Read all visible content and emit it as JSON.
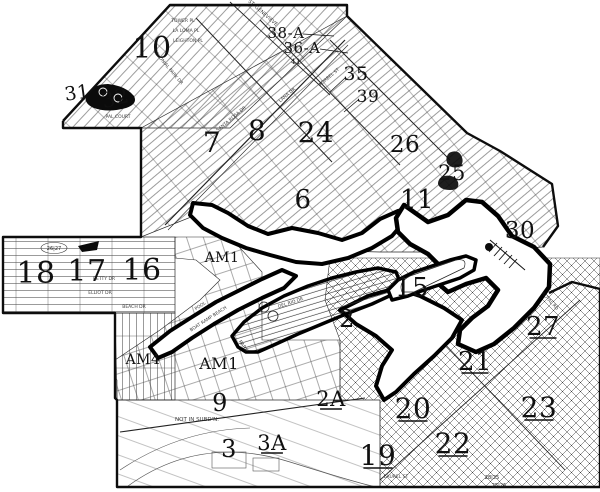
{
  "map": {
    "title": "subdivision-tract-map-scan",
    "colors": {
      "ink": "#101010",
      "paper": "#ffffff",
      "water_outline": "#000000",
      "faint_street": "#3c3c3c"
    },
    "zone_labels": [
      {
        "id": "10",
        "t": "10",
        "x": 152,
        "y": 58,
        "fs": 30
      },
      {
        "id": "31",
        "t": "31",
        "x": 78,
        "y": 99,
        "fs": 19,
        "rot": -8
      },
      {
        "id": "32",
        "t": "32",
        "x": 117,
        "y": 105,
        "fs": 21,
        "rot": -14
      },
      {
        "id": "7",
        "t": "7",
        "x": 212,
        "y": 152,
        "fs": 28
      },
      {
        "id": "8",
        "t": "8",
        "x": 257,
        "y": 140,
        "fs": 28
      },
      {
        "id": "24",
        "t": "24",
        "x": 316,
        "y": 142,
        "fs": 28
      },
      {
        "id": "6",
        "t": "6",
        "x": 303,
        "y": 208,
        "fs": 26
      },
      {
        "id": "26",
        "t": "26",
        "x": 405,
        "y": 152,
        "fs": 23
      },
      {
        "id": "25",
        "t": "25",
        "x": 452,
        "y": 180,
        "fs": 21
      },
      {
        "id": "11",
        "t": "11",
        "x": 417,
        "y": 208,
        "fs": 26
      },
      {
        "id": "30",
        "t": "30",
        "x": 520,
        "y": 238,
        "fs": 23
      },
      {
        "id": "35",
        "t": "35",
        "x": 356,
        "y": 80,
        "fs": 19
      },
      {
        "id": "39",
        "t": "39",
        "x": 368,
        "y": 102,
        "fs": 17
      },
      {
        "id": "38A",
        "t": "38-A",
        "x": 286,
        "y": 38,
        "fs": 15
      },
      {
        "id": "36A",
        "t": "36-A",
        "x": 302,
        "y": 53,
        "fs": 15
      },
      {
        "id": "41",
        "t": "41",
        "x": 296,
        "y": 64,
        "fs": 7
      },
      {
        "id": "18",
        "t": "18",
        "x": 36,
        "y": 283,
        "fs": 30
      },
      {
        "id": "17",
        "t": "17",
        "x": 87,
        "y": 281,
        "fs": 30
      },
      {
        "id": "16",
        "t": "16",
        "x": 142,
        "y": 280,
        "fs": 30
      },
      {
        "id": "15",
        "t": "15",
        "x": 412,
        "y": 296,
        "fs": 26
      },
      {
        "id": "2",
        "t": "2",
        "x": 347,
        "y": 327,
        "fs": 24
      },
      {
        "id": "2A",
        "t": "2A",
        "x": 331,
        "y": 406,
        "fs": 21,
        "u": 1
      },
      {
        "id": "21",
        "t": "21",
        "x": 475,
        "y": 370,
        "fs": 26,
        "u": 1
      },
      {
        "id": "27",
        "t": "27",
        "x": 543,
        "y": 335,
        "fs": 26,
        "u": 1
      },
      {
        "id": "20",
        "t": "20",
        "x": 413,
        "y": 418,
        "fs": 28,
        "u": 1
      },
      {
        "id": "23",
        "t": "23",
        "x": 539,
        "y": 417,
        "fs": 28,
        "u": 1
      },
      {
        "id": "22",
        "t": "22",
        "x": 453,
        "y": 453,
        "fs": 28,
        "u": 1
      },
      {
        "id": "19",
        "t": "19",
        "x": 378,
        "y": 465,
        "fs": 28,
        "u": 1
      },
      {
        "id": "9",
        "t": "9",
        "x": 220,
        "y": 411,
        "fs": 24
      },
      {
        "id": "3",
        "t": "3",
        "x": 229,
        "y": 457,
        "fs": 24
      },
      {
        "id": "3A",
        "t": "3A",
        "x": 272,
        "y": 450,
        "fs": 21,
        "u": 1
      },
      {
        "id": "AM1-lagoon",
        "t": "AM1",
        "x": 222,
        "y": 262,
        "fs": 14
      },
      {
        "id": "AM4",
        "t": "AM4",
        "x": 143,
        "y": 364,
        "fs": 14
      },
      {
        "id": "AM1-park",
        "t": "AM1",
        "x": 219,
        "y": 369,
        "fs": 16
      }
    ],
    "street_labels": [
      {
        "t": "ST. GENEVIEVE",
        "x": 262,
        "y": 14,
        "rot": 41,
        "fs": 5
      },
      {
        "t": "TOWER PL",
        "x": 183,
        "y": 22,
        "fs": 4.5
      },
      {
        "t": "LA LOMA PL",
        "x": 186,
        "y": 32,
        "fs": 4.5
      },
      {
        "t": "LEIGHTON PL",
        "x": 188,
        "y": 42,
        "fs": 4.5
      },
      {
        "t": "COLONIAL PARK DR",
        "x": 167,
        "y": 68,
        "rot": 50,
        "fs": 4.5
      },
      {
        "t": "LANA DR",
        "x": 288,
        "y": 96,
        "rot": -40,
        "fs": 4.5
      },
      {
        "t": "KORBEL ST",
        "x": 330,
        "y": 78,
        "rot": -40,
        "fs": 4.5
      },
      {
        "t": "SANTA ROSA DR",
        "x": 232,
        "y": 120,
        "rot": -40,
        "fs": 4.5
      },
      {
        "t": "PAL COURT",
        "x": 118,
        "y": 118,
        "fs": 4.5
      },
      {
        "t": "BETTY DR",
        "x": 104,
        "y": 280,
        "fs": 4.5
      },
      {
        "t": "ELLIOT DR",
        "x": 100,
        "y": 294,
        "fs": 4.5
      },
      {
        "t": "BEACH DR",
        "x": 134,
        "y": 308,
        "fs": 4.5
      },
      {
        "t": "POOL",
        "x": 201,
        "y": 307,
        "rot": -33,
        "fs": 4.5
      },
      {
        "t": "BOAT RAMP BEACH",
        "x": 209,
        "y": 320,
        "rot": -33,
        "fs": 4.5
      },
      {
        "t": "PARK",
        "x": 242,
        "y": 347,
        "rot": 55,
        "fs": 5
      },
      {
        "t": "DEL RIO DR",
        "x": 291,
        "y": 304,
        "rot": -18,
        "fs": 4.5
      },
      {
        "t": "NOT IN SUBD'N.",
        "x": 197,
        "y": 421,
        "fs": 5.5
      },
      {
        "t": "LAUREL ST",
        "x": 396,
        "y": 478,
        "fs": 4.5
      },
      {
        "t": "ROYAL RD",
        "x": 549,
        "y": 302,
        "rot": 48,
        "fs": 4.5
      }
    ],
    "sheet_refs": [
      {
        "t": "26|27",
        "x": 54,
        "y": 250
      },
      {
        "t": "28|25",
        "x": 492,
        "y": 479
      },
      {
        "t": "25|26",
        "x": 499,
        "y": 487
      }
    ]
  }
}
